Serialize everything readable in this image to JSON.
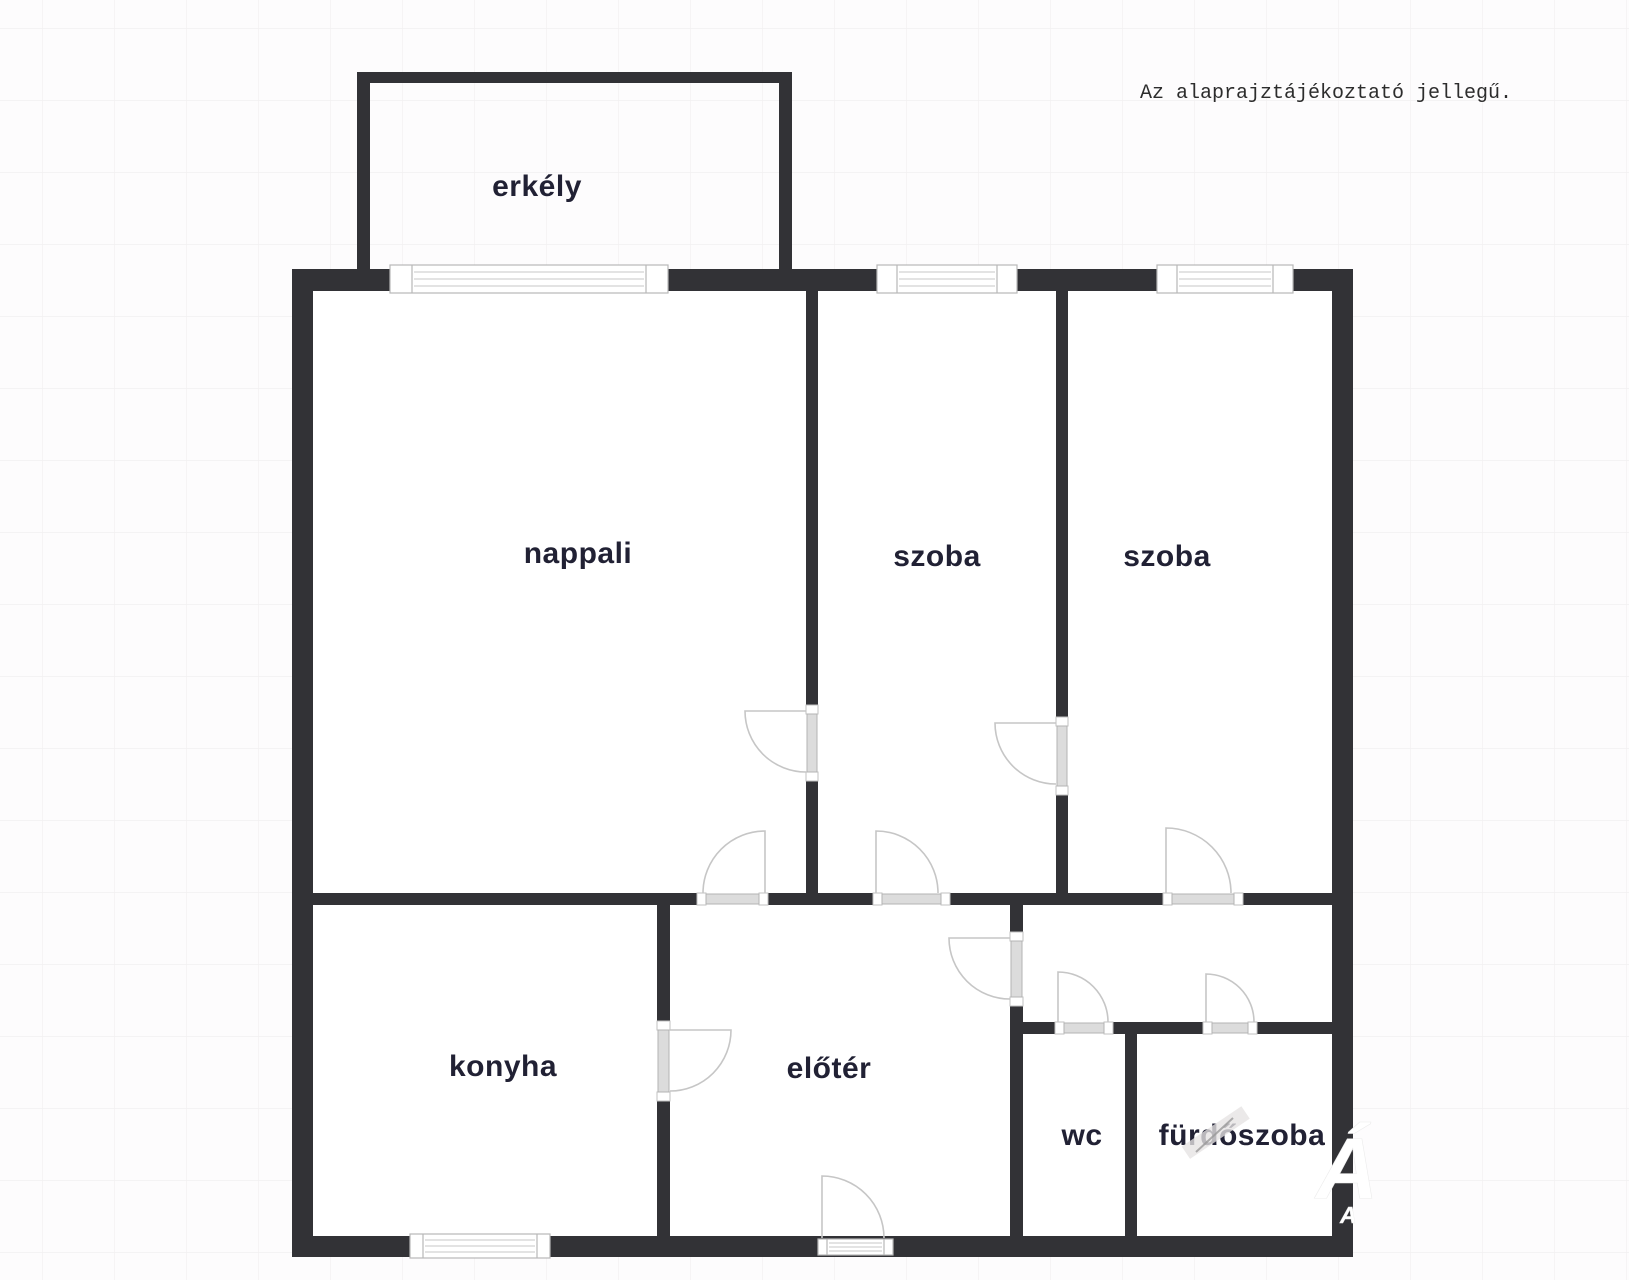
{
  "disclaimer": "Az alaprajztájékoztató jellegű.",
  "rooms": {
    "balcony": {
      "label": "erkély"
    },
    "living": {
      "label": "nappali"
    },
    "room1": {
      "label": "szoba"
    },
    "room2": {
      "label": "szoba"
    },
    "kitchen": {
      "label": "konyha"
    },
    "hall": {
      "label": "előtér"
    },
    "wc": {
      "label": "wc"
    },
    "bathroom": {
      "label": "fürdőszoba"
    }
  },
  "watermark": {
    "big_letter": "Á",
    "small_letter": "A"
  },
  "colors": {
    "wall": "#323236",
    "label_text": "#212134",
    "door_leaf": "#dcdcdc",
    "door_arc": "#c6c6c6",
    "background": "#fdfcfd",
    "grid_line": "#f2f0f1",
    "note_text": "#2d2d2d"
  }
}
